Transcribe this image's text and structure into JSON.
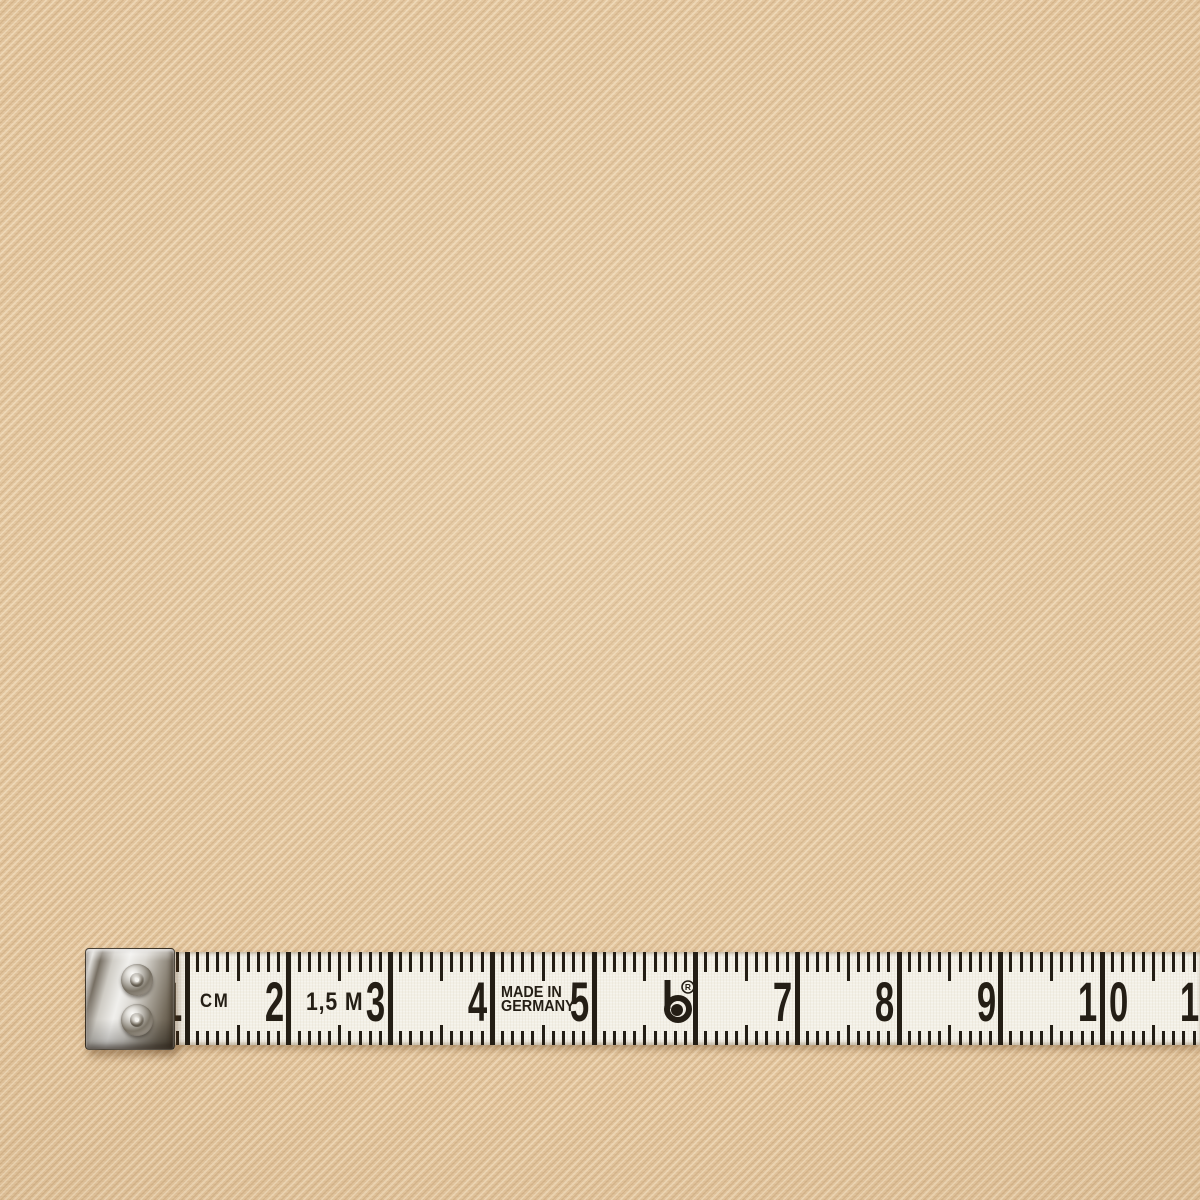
{
  "colors": {
    "fabric-base": "#e3c59d",
    "fabric-light": "#f6e7c8",
    "fabric-dark": "#c6a276",
    "tape-bg": "#f3f0e6",
    "ink": "#241e15",
    "metal-light": "#f0efec",
    "metal-mid": "#9b968e",
    "metal-dark": "#4a4031"
  },
  "tape": {
    "unit_label": "CM",
    "length_label": "1,5 M",
    "made_in_line1": "MADE IN",
    "made_in_line2": "GERMANY",
    "logo_icon": "b-registered-trademark-logo",
    "cm_labels": [
      "1",
      "2",
      "3",
      "4",
      "5",
      "",
      "7",
      "8",
      "9",
      "10",
      "11"
    ],
    "geometry": {
      "tape_left": 150,
      "top": 952,
      "height": 93,
      "zero_x": 85.5,
      "mm_px": 10.17,
      "first_mm": 7,
      "last_mm": 110
    }
  }
}
